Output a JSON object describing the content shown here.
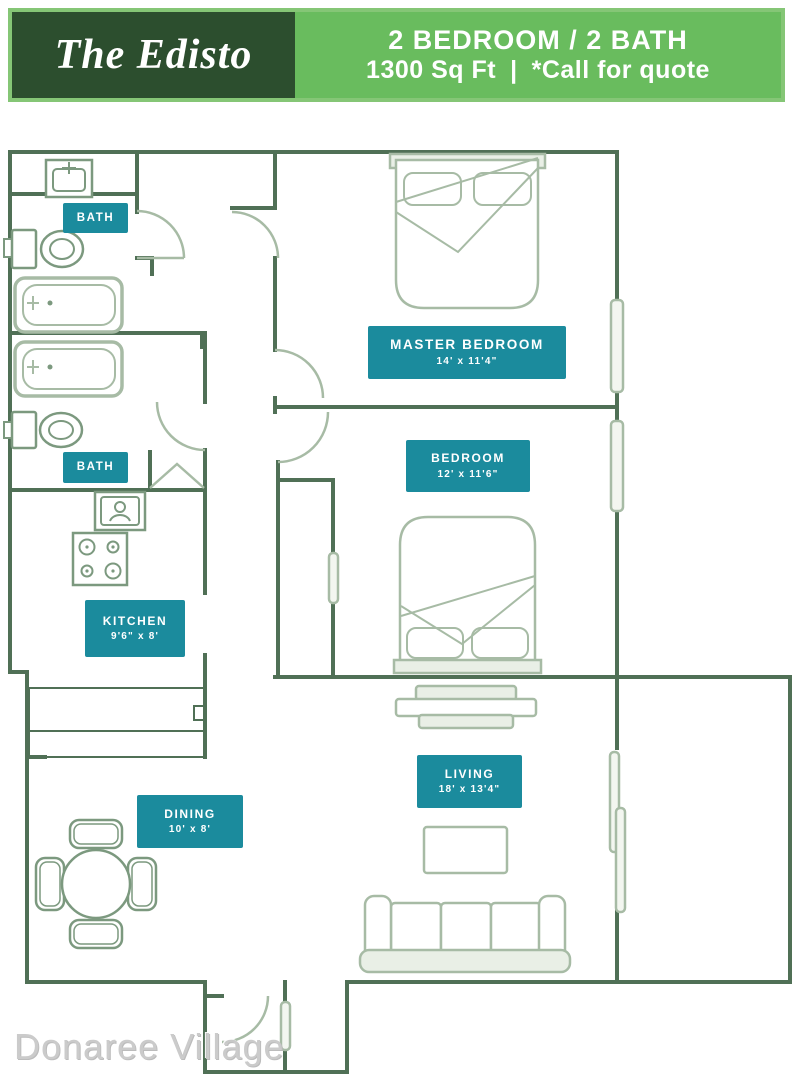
{
  "header": {
    "name_plate": "The Edisto",
    "spec_top": "2 BEDROOM / 2 BATH",
    "spec_sqft": "1300 Sq Ft",
    "spec_divider": "|",
    "spec_quote": "*Call for quote"
  },
  "floor_plan": {
    "rooms": [
      {
        "id": "bath-1",
        "name": "BATH",
        "dims": ""
      },
      {
        "id": "master-bedroom",
        "name": "MASTER BEDROOM",
        "dims": "14' x 11'4\""
      },
      {
        "id": "bedroom",
        "name": "BEDROOM",
        "dims": "12' x 11'6\""
      },
      {
        "id": "bath-2",
        "name": "BATH",
        "dims": ""
      },
      {
        "id": "kitchen",
        "name": "KITCHEN",
        "dims": "9'6\" x 8'"
      },
      {
        "id": "dining",
        "name": "DINING",
        "dims": "10' x 8'"
      },
      {
        "id": "living",
        "name": "LIVING",
        "dims": "18' x 13'4\""
      }
    ],
    "fixtures": [
      "sink-vanity",
      "toilet",
      "bathtub",
      "bathtub",
      "toilet",
      "sink-vanity",
      "stove",
      "kitchen-counter",
      "dining-table-with-four-chairs",
      "double-bed",
      "double-bed",
      "tv-console",
      "coffee-table",
      "sofa",
      "sliding-glass-door",
      "window",
      "window",
      "entry-door",
      "closet"
    ]
  },
  "watermark": "Donaree Village",
  "colors": {
    "banner_dark_green": "#2C4E2E",
    "banner_light_green": "#69BC5E",
    "banner_border_green": "#85C676",
    "room_label_teal": "#1B8B9D",
    "wall_green": "#507056",
    "fixture_light_sage": "#A7BBA5",
    "fixture_mid_sage": "#7C997F",
    "watermark_gray": "#C9C9C9"
  }
}
